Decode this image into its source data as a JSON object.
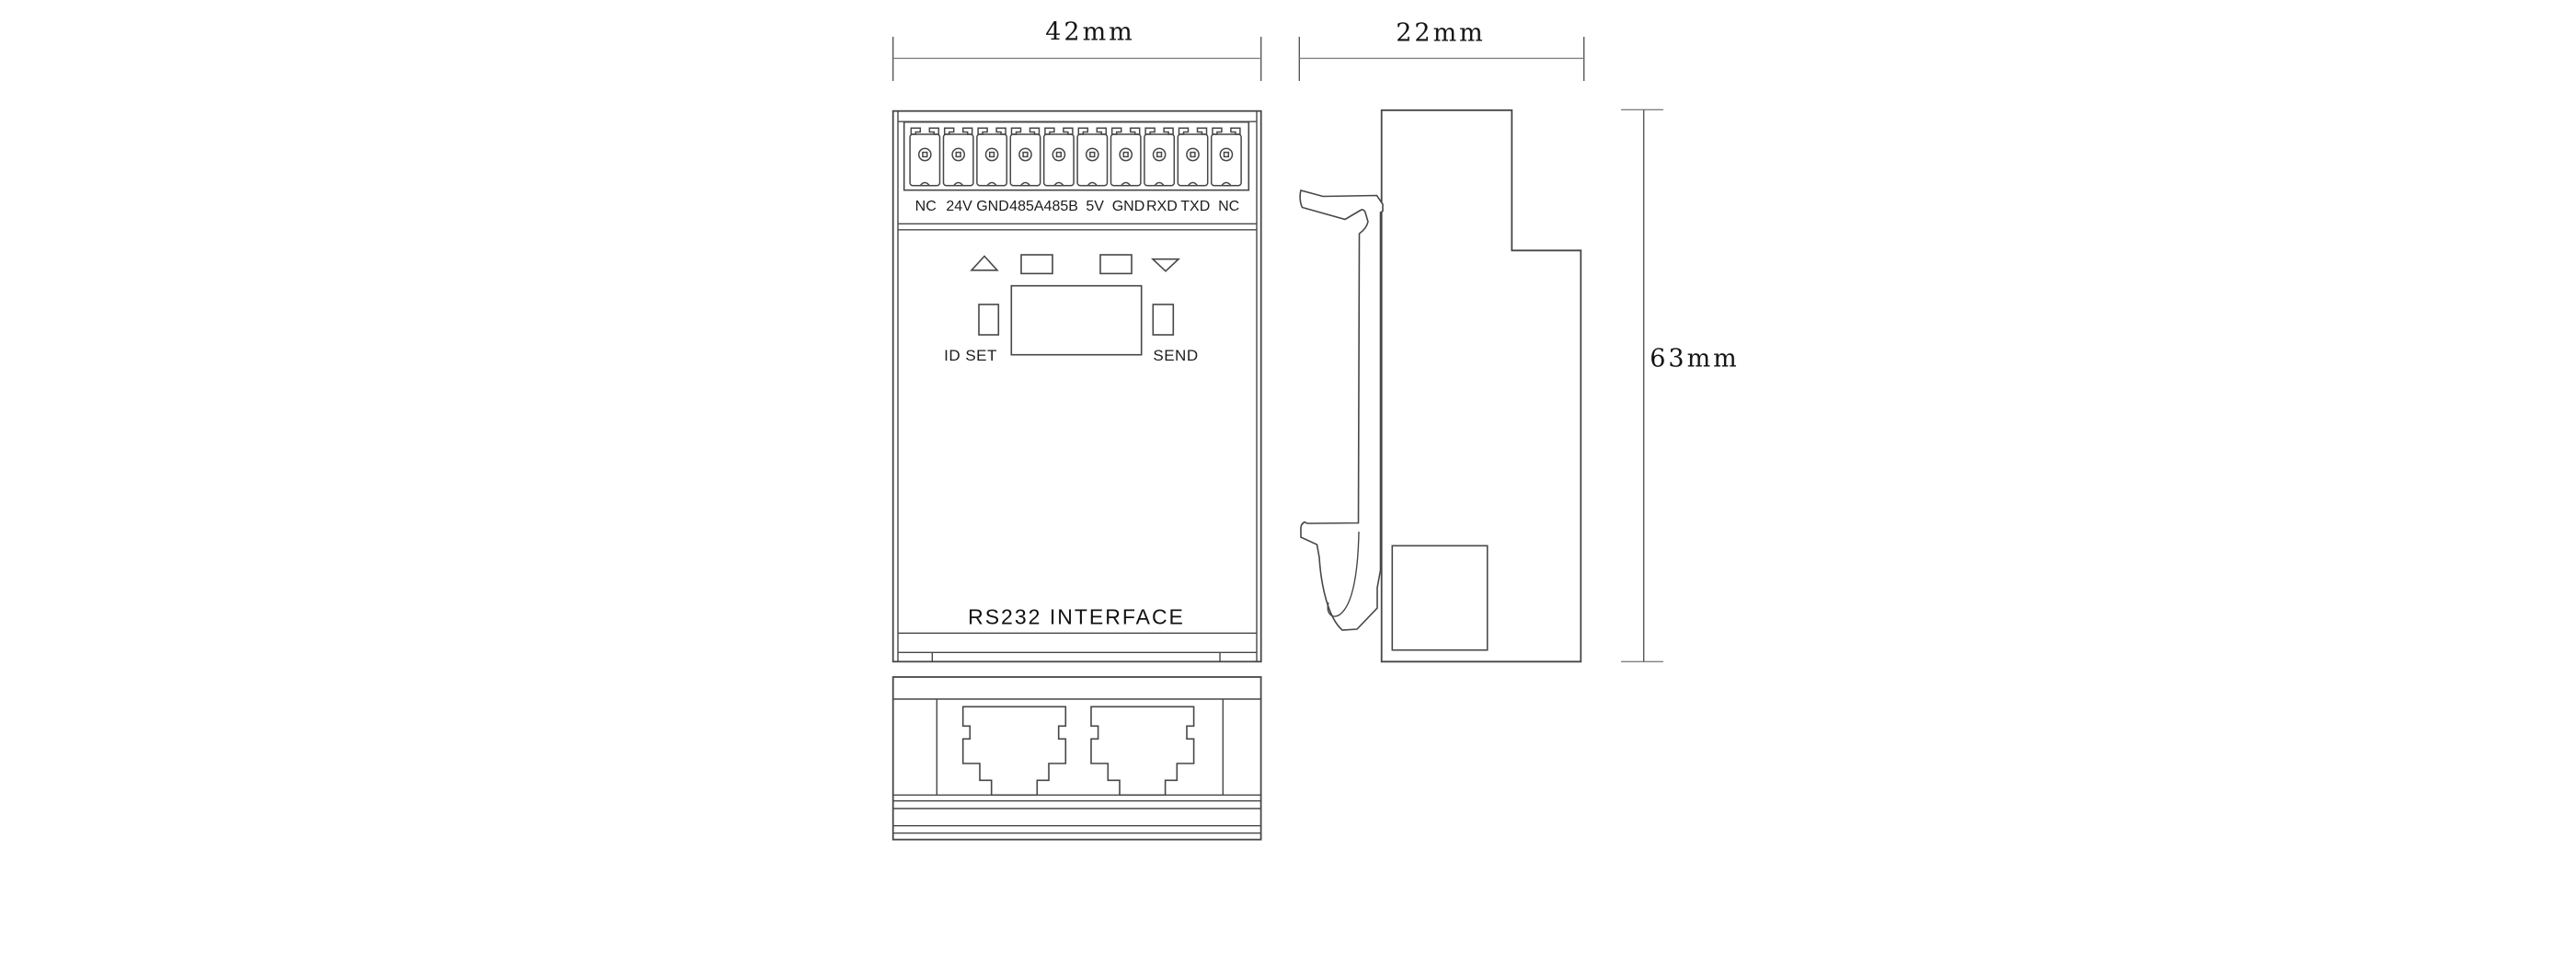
{
  "drawing": {
    "background": "#ffffff",
    "line_color": "#474747",
    "dimension_line_color": "#828282",
    "text_color": "#141414",
    "view_names": {
      "front": "front-view",
      "side": "side-view",
      "bottom": "bottom-view"
    }
  },
  "dimensions": {
    "front_width_label": "42mm",
    "side_depth_label": "22mm",
    "height_label": "63mm"
  },
  "front_view": {
    "terminal_labels": [
      "NC",
      "24V",
      "GND",
      "485A",
      "485B",
      "5V",
      "GND",
      "RXD",
      "TXD",
      "NC"
    ],
    "id_set_label": "ID SET",
    "send_label": "SEND",
    "product_label": "RS232 INTERFACE"
  }
}
